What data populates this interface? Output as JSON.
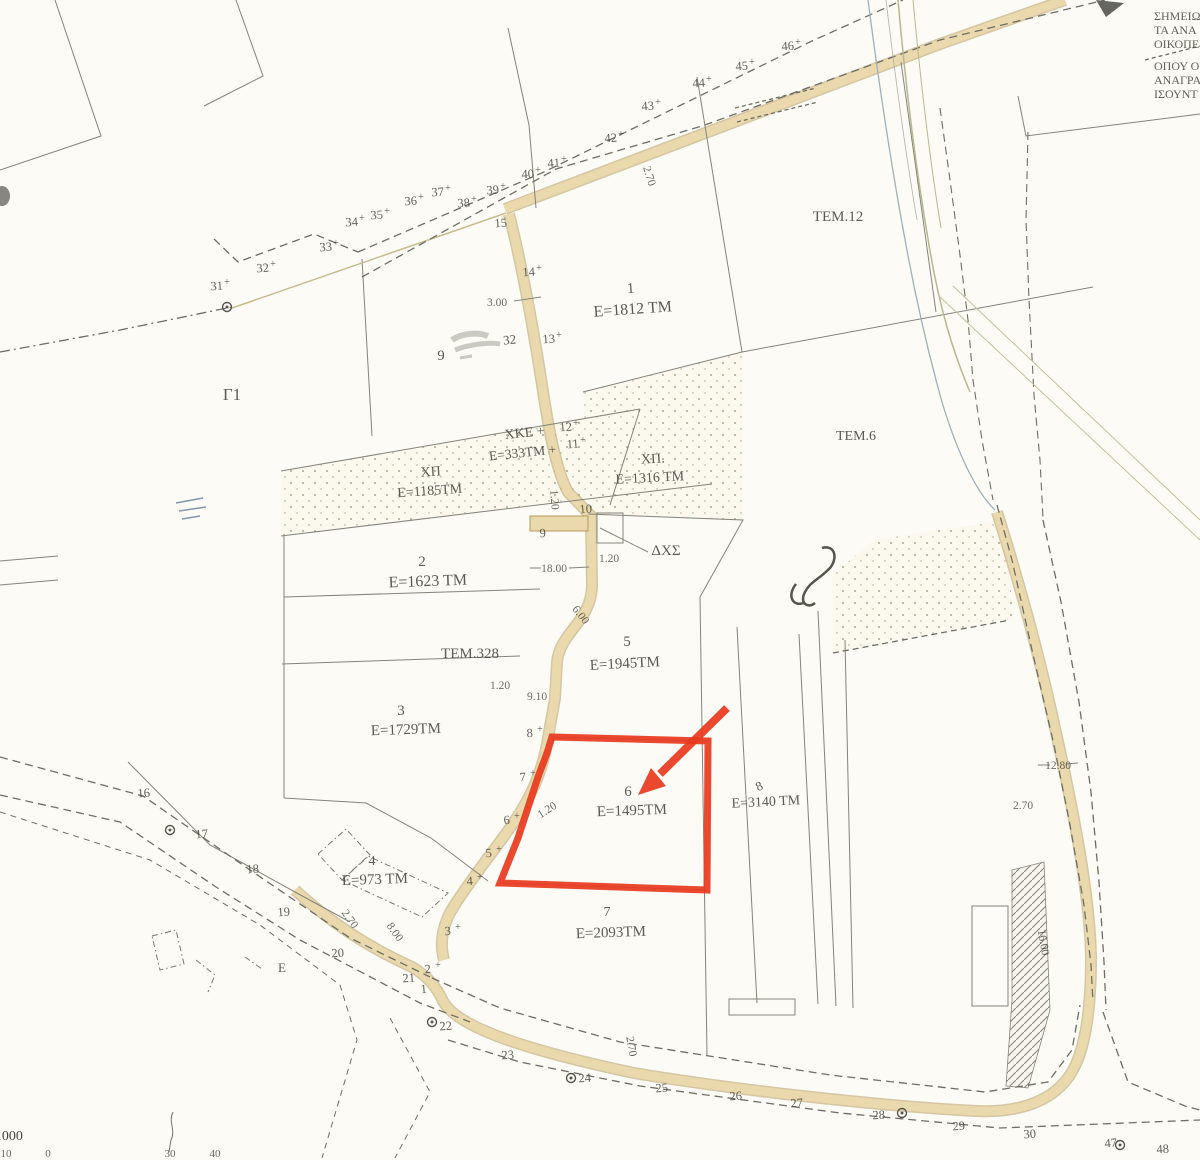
{
  "title": "cadastral-plan-scan",
  "note": {
    "lines": [
      "ΣΗΜΕΙΩ",
      "ΤΑ ΑΝΑ",
      "ΟΙΚΟΠΕ",
      "ΟΠΟΥ Ο",
      "ΑΝΑΓΡΑ",
      "ΙΣΟΥΝΤ"
    ]
  },
  "highlight": {
    "parcel": "6",
    "area": "Ε=1495ΤΜ",
    "color": "#e8391d"
  },
  "scale": {
    "label": "1:1000",
    "ruler": [
      {
        "t": "10",
        "x": 6
      },
      {
        "t": "0",
        "x": 48
      },
      {
        "t": "30",
        "x": 170
      },
      {
        "t": "40",
        "x": 215
      }
    ]
  },
  "parcel_labels": [
    {
      "t": "Γ1",
      "x": 232,
      "y": 400,
      "s": 17,
      "r": 0
    },
    {
      "t": "9",
      "x": 441,
      "y": 360,
      "s": 15,
      "r": 0
    },
    {
      "t": "1",
      "x": 631,
      "y": 293,
      "s": 15,
      "r": -4
    },
    {
      "t": "Ε=1812 ΤΜ",
      "x": 633,
      "y": 314,
      "s": 16,
      "r": -4
    },
    {
      "t": "ΤΕΜ.12",
      "x": 838,
      "y": 221,
      "s": 15,
      "r": 0
    },
    {
      "t": "ΤΕΜ.6",
      "x": 856,
      "y": 440,
      "s": 14,
      "r": 0
    },
    {
      "t": "ΧΚΕ +",
      "x": 525,
      "y": 437,
      "s": 14,
      "r": -6
    },
    {
      "t": "Ε=333ΤΜ +",
      "x": 523,
      "y": 457,
      "s": 13.5,
      "r": -6
    },
    {
      "t": "ΧΠ",
      "x": 431,
      "y": 476,
      "s": 14,
      "r": -4
    },
    {
      "t": "Ε=1185ΤΜ",
      "x": 430,
      "y": 495,
      "s": 14,
      "r": -4
    },
    {
      "t": "ΧΠ.",
      "x": 653,
      "y": 463,
      "s": 14,
      "r": -3
    },
    {
      "t": "Ε=1316 ΤΜ",
      "x": 650,
      "y": 482,
      "s": 14,
      "r": -3
    },
    {
      "t": "2",
      "x": 422,
      "y": 566,
      "s": 15,
      "r": 0
    },
    {
      "t": "Ε=1623 ΤΜ",
      "x": 428,
      "y": 586,
      "s": 16,
      "r": -2
    },
    {
      "t": "ΔΧΣ",
      "x": 666,
      "y": 555,
      "s": 15,
      "r": 0
    },
    {
      "t": "ΤΕΜ.328",
      "x": 470,
      "y": 658,
      "s": 15,
      "r": 0
    },
    {
      "t": "5",
      "x": 627,
      "y": 646,
      "s": 15,
      "r": 0
    },
    {
      "t": "Ε=1945ΤΜ",
      "x": 625,
      "y": 668,
      "s": 15,
      "r": -3
    },
    {
      "t": "3",
      "x": 401,
      "y": 715,
      "s": 15,
      "r": 0
    },
    {
      "t": "Ε=1729ΤΜ",
      "x": 406,
      "y": 734,
      "s": 15,
      "r": -2
    },
    {
      "t": "6",
      "x": 628,
      "y": 796,
      "s": 15,
      "r": 0
    },
    {
      "t": "Ε=1495ΤΜ",
      "x": 632,
      "y": 815,
      "s": 15,
      "r": -2
    },
    {
      "t": "8",
      "x": 761,
      "y": 790,
      "s": 13,
      "r": -25
    },
    {
      "t": "Ε=3140 ΤΜ",
      "x": 766,
      "y": 806,
      "s": 14,
      "r": -3
    },
    {
      "t": "4",
      "x": 372,
      "y": 865,
      "s": 14,
      "r": 0
    },
    {
      "t": "Ε=973 ΤΜ",
      "x": 375,
      "y": 884,
      "s": 15,
      "r": -2
    },
    {
      "t": "7",
      "x": 607,
      "y": 916,
      "s": 14,
      "r": 0
    },
    {
      "t": "Ε=2093ΤΜ",
      "x": 611,
      "y": 937,
      "s": 15,
      "r": -2
    },
    {
      "t": "Ε",
      "x": 282,
      "y": 972,
      "s": 13,
      "r": 0
    },
    {
      "t": "32",
      "x": 510,
      "y": 344,
      "s": 13,
      "r": -5
    }
  ],
  "dim_labels": [
    {
      "t": "3.00",
      "x": 497,
      "y": 306,
      "r": 0
    },
    {
      "t": "2.70",
      "x": 646,
      "y": 177,
      "r": 73
    },
    {
      "t": "1.20",
      "x": 551,
      "y": 500,
      "r": 85
    },
    {
      "t": "18.00",
      "x": 554,
      "y": 572,
      "r": 0
    },
    {
      "t": "6.00",
      "x": 578,
      "y": 617,
      "r": 52
    },
    {
      "t": "1.20",
      "x": 500,
      "y": 689,
      "r": 0
    },
    {
      "t": "9.10",
      "x": 537,
      "y": 700,
      "r": 0
    },
    {
      "t": "1.20",
      "x": 609,
      "y": 562,
      "r": 0
    },
    {
      "t": "1.20",
      "x": 549,
      "y": 813,
      "r": -33
    },
    {
      "t": "2.70",
      "x": 347,
      "y": 921,
      "r": 55
    },
    {
      "t": "8.00",
      "x": 392,
      "y": 934,
      "r": 55
    },
    {
      "t": "2.70",
      "x": 628,
      "y": 1047,
      "r": 80
    },
    {
      "t": "2.70",
      "x": 1023,
      "y": 809,
      "r": 0
    },
    {
      "t": "12.80",
      "x": 1058,
      "y": 769,
      "r": 0
    },
    {
      "t": "16.00",
      "x": 1040,
      "y": 943,
      "r": 80
    }
  ],
  "points": [
    {
      "n": "1",
      "x": 424,
      "y": 993
    },
    {
      "n": "2",
      "x": 428,
      "y": 973,
      "m": "+"
    },
    {
      "n": "3",
      "x": 448,
      "y": 935,
      "m": "+"
    },
    {
      "n": "4",
      "x": 470,
      "y": 885,
      "m": "+"
    },
    {
      "n": "5",
      "x": 489,
      "y": 857,
      "m": "+"
    },
    {
      "n": "6",
      "x": 507,
      "y": 824,
      "m": "+"
    },
    {
      "n": "7",
      "x": 523,
      "y": 781,
      "m": "+"
    },
    {
      "n": "8",
      "x": 530,
      "y": 737,
      "m": "+"
    },
    {
      "n": "9",
      "x": 543,
      "y": 537
    },
    {
      "n": "10",
      "x": 586,
      "y": 513
    },
    {
      "n": "11",
      "x": 573,
      "y": 448,
      "m": "+"
    },
    {
      "n": "12",
      "x": 566,
      "y": 431,
      "m": "+"
    },
    {
      "n": "13",
      "x": 549,
      "y": 343,
      "m": "+"
    },
    {
      "n": "14",
      "x": 529,
      "y": 276,
      "m": "+"
    },
    {
      "n": "15",
      "x": 501,
      "y": 227
    },
    {
      "n": "16",
      "x": 144,
      "y": 797
    },
    {
      "n": "17",
      "x": 202,
      "y": 838
    },
    {
      "n": "18",
      "x": 253,
      "y": 873
    },
    {
      "n": "19",
      "x": 284,
      "y": 916
    },
    {
      "n": "20",
      "x": 338,
      "y": 957
    },
    {
      "n": "21",
      "x": 409,
      "y": 982
    },
    {
      "n": "22",
      "x": 446,
      "y": 1030
    },
    {
      "n": "23",
      "x": 508,
      "y": 1059
    },
    {
      "n": "24",
      "x": 585,
      "y": 1082
    },
    {
      "n": "25",
      "x": 662,
      "y": 1092
    },
    {
      "n": "26",
      "x": 736,
      "y": 1100
    },
    {
      "n": "27",
      "x": 797,
      "y": 1107
    },
    {
      "n": "28",
      "x": 879,
      "y": 1119
    },
    {
      "n": "29",
      "x": 959,
      "y": 1130
    },
    {
      "n": "30",
      "x": 1030,
      "y": 1138
    },
    {
      "n": "31",
      "x": 217,
      "y": 290,
      "m": "+"
    },
    {
      "n": "32",
      "x": 263,
      "y": 272,
      "m": "+"
    },
    {
      "n": "33",
      "x": 326,
      "y": 251,
      "m": "+"
    },
    {
      "n": "34",
      "x": 352,
      "y": 226,
      "m": "+"
    },
    {
      "n": "35",
      "x": 377,
      "y": 219,
      "m": "+"
    },
    {
      "n": "36",
      "x": 411,
      "y": 205,
      "m": "+"
    },
    {
      "n": "37",
      "x": 438,
      "y": 196,
      "m": "+"
    },
    {
      "n": "38",
      "x": 464,
      "y": 207,
      "m": "+"
    },
    {
      "n": "39",
      "x": 493,
      "y": 194,
      "m": "+"
    },
    {
      "n": "40",
      "x": 528,
      "y": 178,
      "m": "+"
    },
    {
      "n": "41",
      "x": 554,
      "y": 167,
      "m": "+"
    },
    {
      "n": "42",
      "x": 611,
      "y": 142,
      "m": "+"
    },
    {
      "n": "43",
      "x": 648,
      "y": 110,
      "m": "+"
    },
    {
      "n": "44",
      "x": 699,
      "y": 87,
      "m": "+"
    },
    {
      "n": "45",
      "x": 742,
      "y": 70,
      "m": "+"
    },
    {
      "n": "46",
      "x": 788,
      "y": 50,
      "m": "+"
    },
    {
      "n": "47",
      "x": 1111,
      "y": 1147
    },
    {
      "n": "48",
      "x": 1163,
      "y": 1153
    }
  ],
  "survey_circles": [
    [
      170,
      830
    ],
    [
      432,
      1022
    ],
    [
      571,
      1078
    ],
    [
      902,
      1113
    ],
    [
      1120,
      1145
    ],
    [
      227,
      307
    ]
  ],
  "colors": {
    "paper": "#fcfbf6",
    "line": "#84847a",
    "dash": "#6e6e64",
    "road_fill": "#ead9ac",
    "road_edge": "#b49a60",
    "highlight": "#e8391d",
    "text": "#45453d"
  }
}
